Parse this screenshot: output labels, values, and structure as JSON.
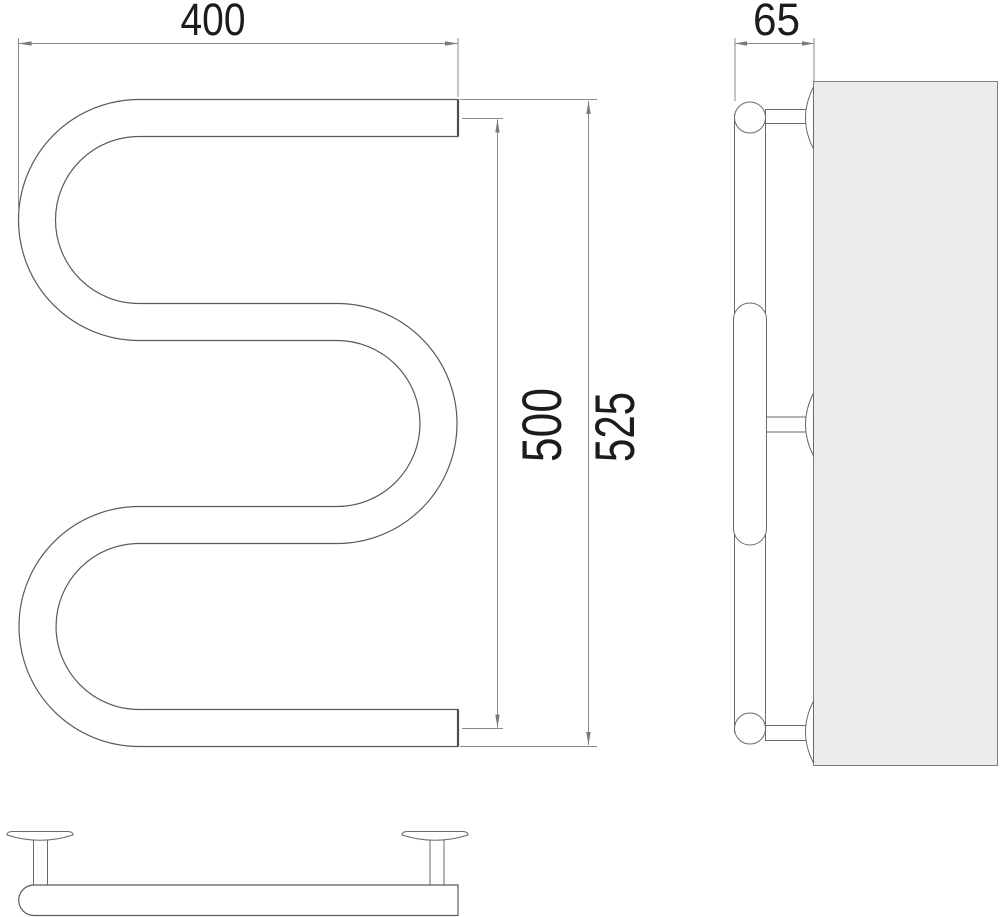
{
  "drawing": {
    "dimensions": {
      "width": "400",
      "pipe_axis_height": "500",
      "overall_height": "525",
      "depth": "65"
    },
    "colors": {
      "background": "#ffffff",
      "line": "#6a6a6a",
      "tube_outline": "#5a5a5a",
      "dimension_line": "#8a8a8a",
      "text": "#1c1c1c",
      "wall_fill": "#ececec",
      "wall_stroke": "#7e7e7e"
    }
  }
}
